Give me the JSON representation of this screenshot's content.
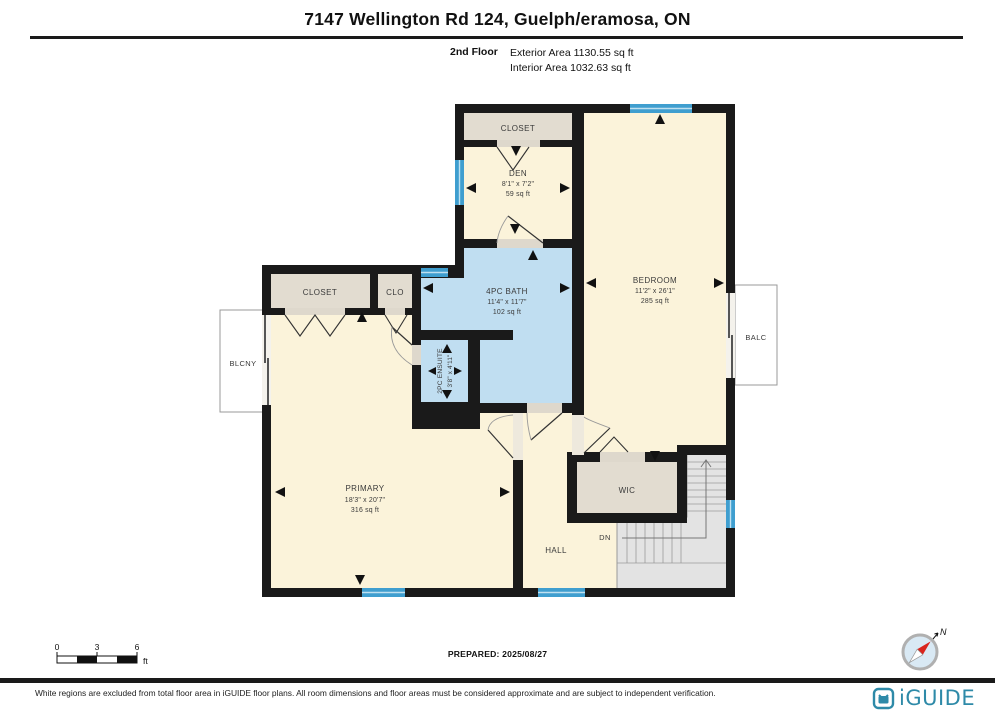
{
  "header": {
    "title": "7147 Wellington Rd 124, Guelph/eramosa, ON",
    "floor_label": "2nd Floor",
    "exterior_area": "Exterior Area 1130.55 sq ft",
    "interior_area": "Interior Area 1032.63 sq ft"
  },
  "plan": {
    "rooms": {
      "closet_top": {
        "name": "CLOSET"
      },
      "den": {
        "name": "DEN",
        "dims": "8'1\" x 7'2\"",
        "area": "59 sq ft"
      },
      "bedroom": {
        "name": "BEDROOM",
        "dims": "11'2\" x 26'1\"",
        "area": "285 sq ft"
      },
      "closet_left": {
        "name": "CLOSET"
      },
      "clo": {
        "name": "CLO"
      },
      "bath": {
        "name": "4PC BATH",
        "dims": "11'4\" x 11'7\"",
        "area": "102 sq ft"
      },
      "ensuite": {
        "name": "2PC ENSUITE",
        "dims": "3'8\" x 4'11\""
      },
      "primary": {
        "name": "PRIMARY",
        "dims": "18'3\" x 20'7\"",
        "area": "316 sq ft"
      },
      "wic": {
        "name": "WIC"
      },
      "hall": {
        "name": "HALL"
      },
      "down": {
        "name": "DN"
      },
      "balcony_left": {
        "name": "BLCNY"
      },
      "balcony_right": {
        "name": "BALC"
      }
    }
  },
  "scale_bar": {
    "ticks": [
      "0",
      "3",
      "6"
    ],
    "unit": "ft"
  },
  "prepared_label": "PREPARED: 2025/08/27",
  "compass": {
    "north_label": "N"
  },
  "footer": {
    "disclaimer": "White regions are excluded from total floor area in iGUIDE floor plans. All room dimensions and floor areas must be considered approximate and are subject to independent verification.",
    "brand": "iGUIDE"
  },
  "colors": {
    "room_fill": "#fbf3da",
    "closet_fill": "#e2dcd0",
    "bath_fill": "#c0def1",
    "window_blue": "#3f9ecf",
    "stairs_fill": "#e3e3e3",
    "wall": "#1a1a1a",
    "brand_teal": "#2e8aa8"
  }
}
